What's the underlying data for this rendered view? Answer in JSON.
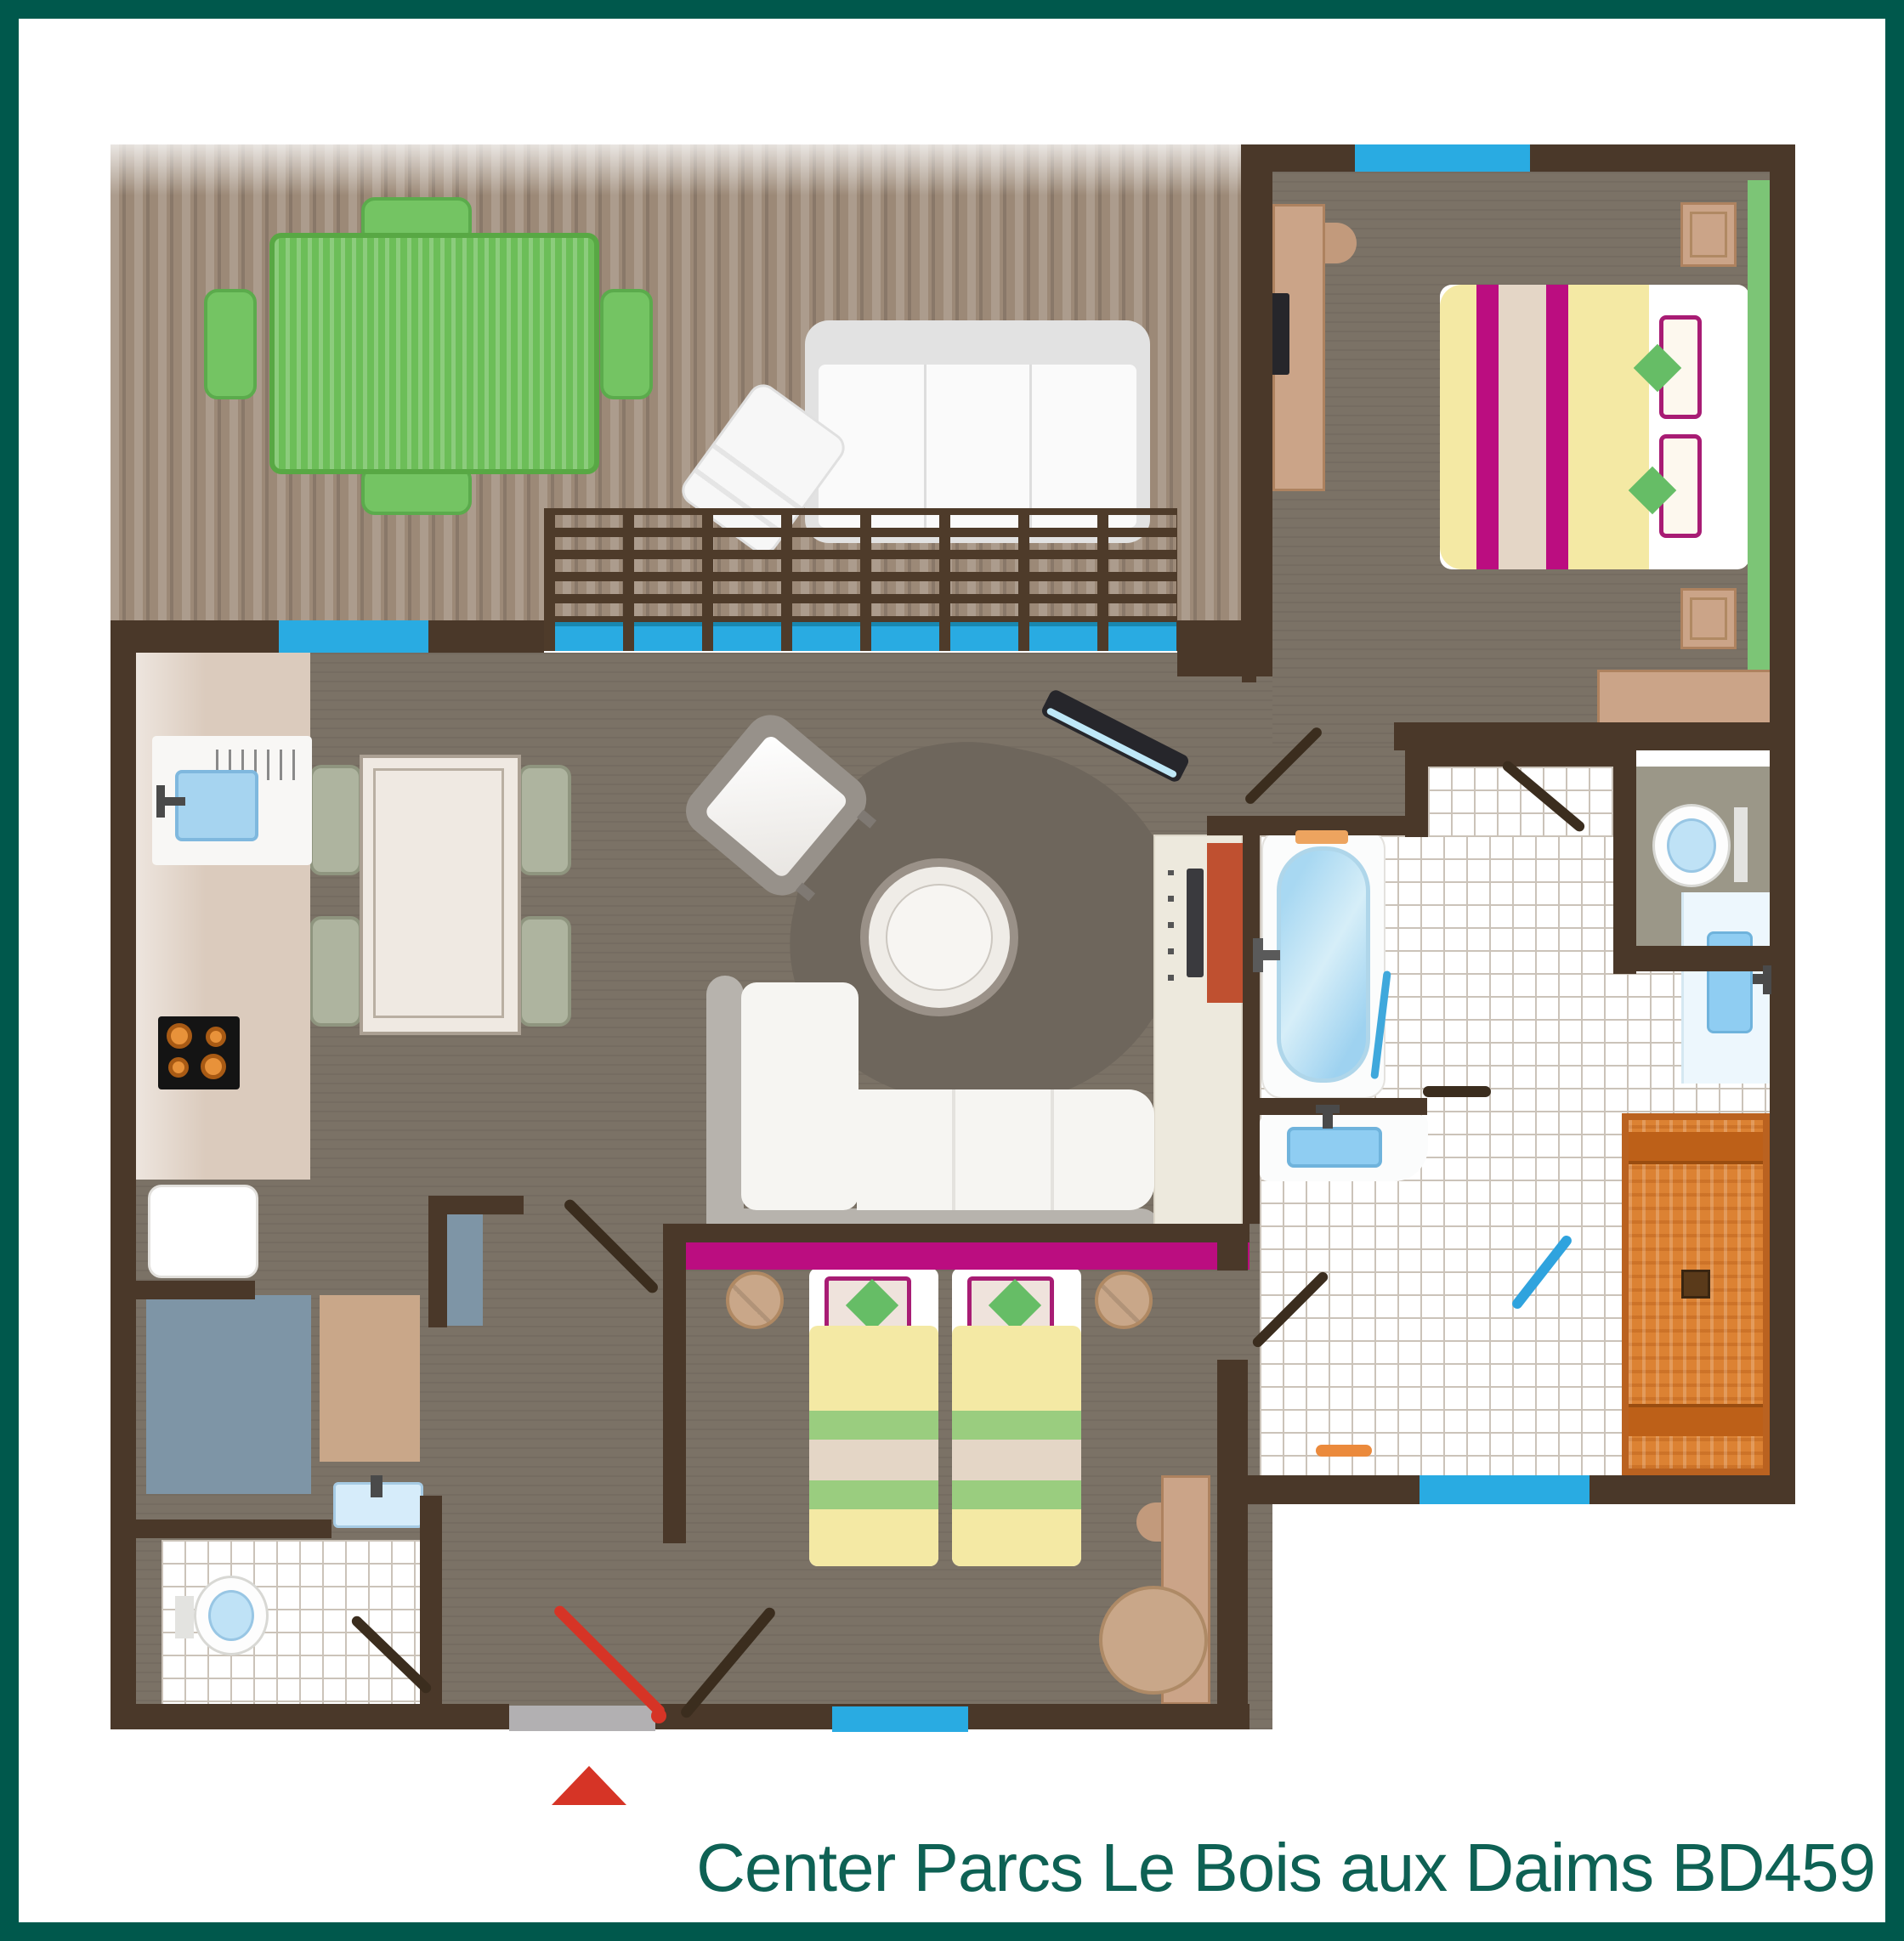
{
  "title": {
    "text": "Center Parcs Le Bois aux Daims BD459"
  },
  "colors": {
    "frame_teal": "#00584C",
    "caption_teal": "#0E6154",
    "wall_brown": "#4A3829",
    "deck_wood": "#9C8977",
    "interior_floor": "#7B7266",
    "rug": "#6E665C",
    "window_blue": "#29ABE2",
    "accent_magenta": "#BB0D80",
    "bed_yellow": "#F4E9A4",
    "stripe_beige": "#E4D6C6",
    "green_textile": "#66BD66",
    "green_runner": "#7CC576",
    "garden_table_green": "#6CBE58",
    "kitchen_counter": "#DBCBBD",
    "sanitary_blue": "#8FCDF2",
    "tan_furniture": "#CBA488",
    "slate_cupboard": "#7E95A6",
    "sauna_orange": "#DC8233",
    "sauna_bench": "#BD6018",
    "red_accent_panel": "#BF5030",
    "entry_door_red": "#D63426",
    "doormat_gray": "#B2B0B2"
  },
  "rooms": [
    {
      "name": "terrace",
      "furniture": [
        "green-garden-table",
        "garden-chairs",
        "outdoor-sofa",
        "outdoor-lounge-chair",
        "slatted-screen"
      ]
    },
    {
      "name": "living-room",
      "furniture": [
        "dining-table",
        "dining-chairs",
        "armchair",
        "round-coffee-table",
        "corner-sofa",
        "rug",
        "tv-console",
        "sliding-glass-door"
      ]
    },
    {
      "name": "kitchen",
      "furniture": [
        "counter",
        "kitchen-sink",
        "hob",
        "appliance"
      ]
    },
    {
      "name": "master-bedroom",
      "furniture": [
        "double-bed",
        "nightstands",
        "desk",
        "desk-chair",
        "tv",
        "wardrobe",
        "green-runner"
      ]
    },
    {
      "name": "bathroom",
      "furniture": [
        "bathtub",
        "washbasin",
        "wall-vanity",
        "shower-hose",
        "bath-mat"
      ]
    },
    {
      "name": "sauna",
      "furniture": [
        "benches",
        "stove"
      ]
    },
    {
      "name": "toilet-room",
      "furniture": [
        "toilet"
      ]
    },
    {
      "name": "kids-bedroom",
      "furniture": [
        "twin-bed-left",
        "twin-bed-right",
        "stools",
        "kids-desk",
        "beanbag"
      ]
    },
    {
      "name": "wc",
      "furniture": [
        "toilet",
        "hand-basin"
      ]
    },
    {
      "name": "hallway",
      "furniture": [
        "storage-cupboard",
        "mat",
        "slate-door-panel"
      ]
    }
  ],
  "markers": {
    "entrance_arrow": "red-triangle",
    "entrance_doormat": "gray"
  },
  "window_openings": [
    "terrace-wall-window",
    "terrace-screen-glazing",
    "bedroom-north-window",
    "kids-room-south-window",
    "bathroom-south-window"
  ]
}
